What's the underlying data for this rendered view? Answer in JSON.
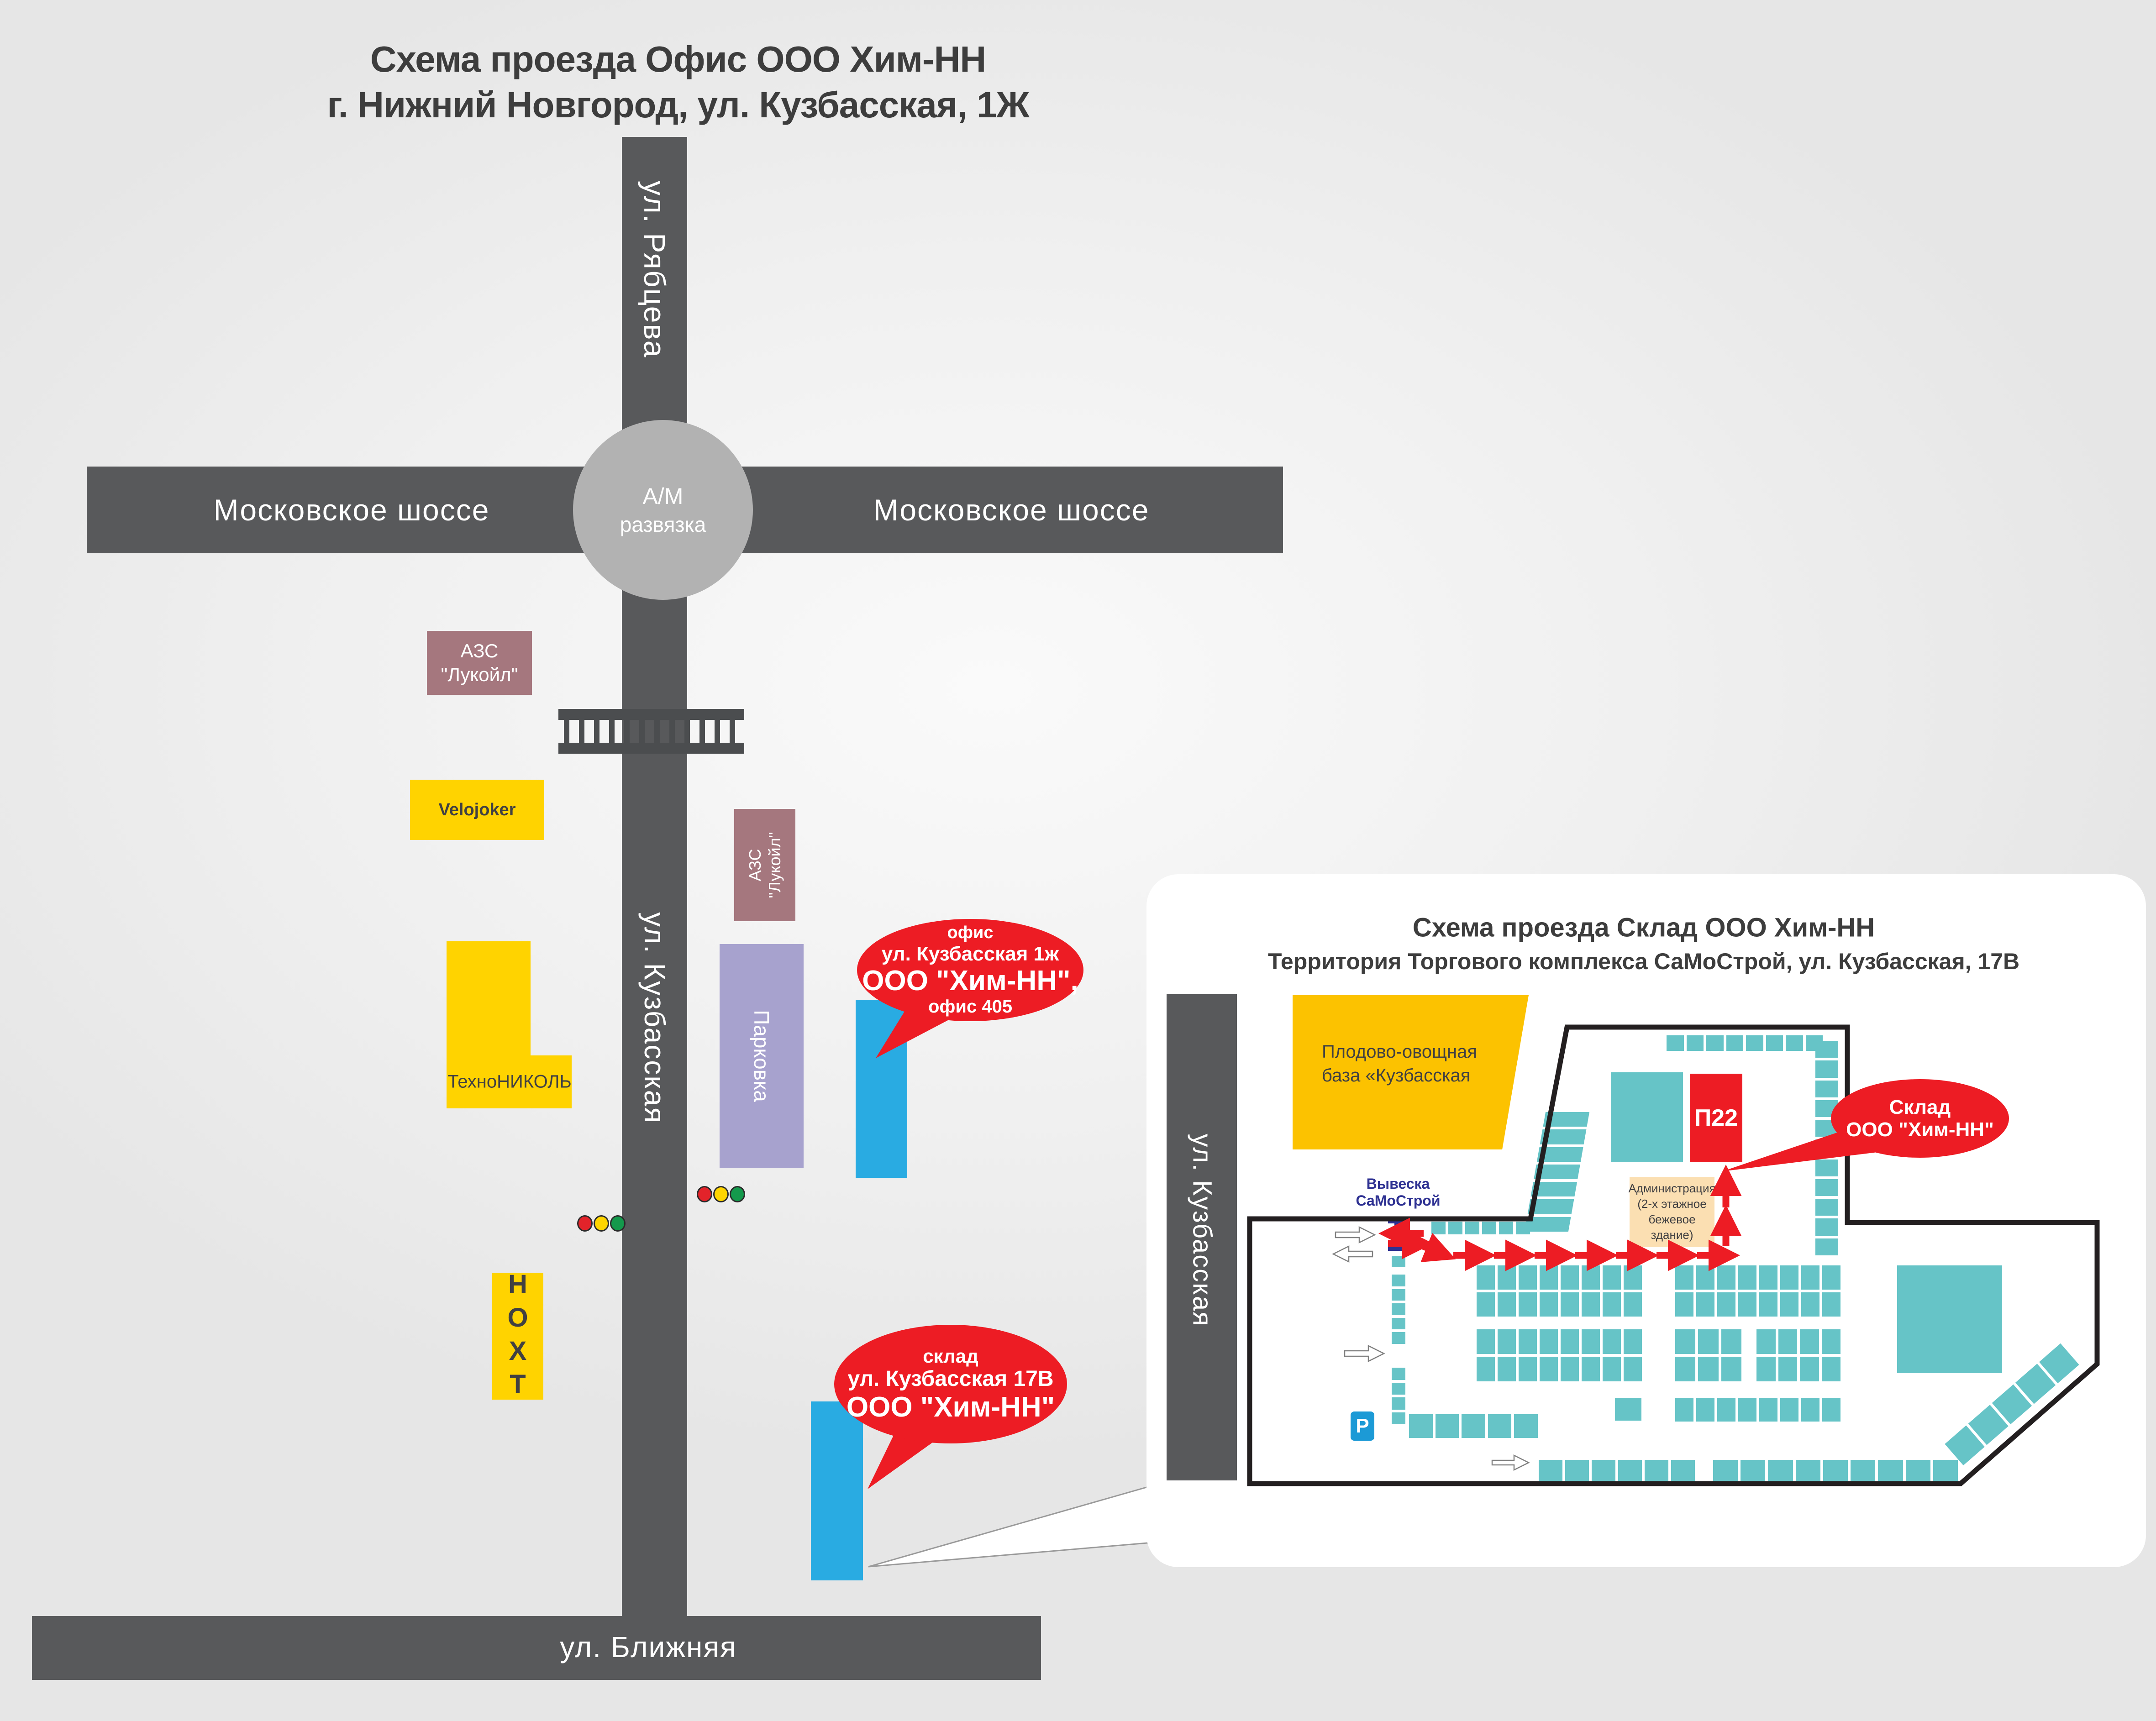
{
  "main": {
    "title": {
      "line1": "Схема проезда Офис ООО Хим-НН",
      "line2": "г. Нижний Новгород, ул. Кузбасская, 1Ж"
    },
    "roads": {
      "ryabtseva": "ул. Рябцева",
      "moscow_left": "Московское шоссе",
      "moscow_right": "Московское шоссе",
      "kuzbasskaya": "ул. Кузбасская",
      "blizhnyaya": "ул. Ближняя"
    },
    "interchange": {
      "line1": "А/М",
      "line2": "развязка"
    },
    "azs_top": {
      "line1": "АЗС",
      "line2": "\"Лукойл\""
    },
    "azs_lower": {
      "line1": "АЗС",
      "line2": "\"Лукойл\""
    },
    "velojoker": "Velojoker",
    "technonicol": "ТехноНИКОЛЬ",
    "parking": "Парковка",
    "noht": "НОХТ",
    "office_callout": {
      "line1": "офис",
      "line2": "ул. Кузбасская 1ж",
      "line3": "ООО \"Хим-НН\",",
      "line4": "офис 405"
    },
    "sklad_callout": {
      "line1": "склад",
      "line2": "ул. Кузбасская 17В",
      "line3": "ООО \"Хим-НН\""
    }
  },
  "inset": {
    "title": {
      "line1": "Схема проезда Склад ООО Хим-НН",
      "line2": "Территория Торгового комплекса СаМоСтрой, ул. Кузбасская, 17В"
    },
    "road": "ул. Кузбасская",
    "base": {
      "line1": "Плодово-овощная",
      "line2": "база «Кузбасская"
    },
    "p22": "П22",
    "sklad_bubble": {
      "line1": "Склад",
      "line2": "ООО \"Хим-НН\""
    },
    "signboard": {
      "line1": "Вывеска",
      "line2": "СаМоСтрой"
    },
    "admin": {
      "line1": "Администрация",
      "line2": "(2-х этажное",
      "line3": "бежевое",
      "line4": "здание)"
    },
    "parking_sign": "P"
  },
  "colors": {
    "road": "#58595b",
    "rail": "#4b4d4f",
    "circle_gray": "#b2b2b2",
    "accent_red": "#ed1c24",
    "building_blue": "#29abe2",
    "pavilion_teal": "#66c4c7",
    "yellow": "#ffd300",
    "base_yellow": "#fcc200",
    "mauve": "#a5777e",
    "purple": "#a7a2ce",
    "beige": "#fbdfb2",
    "navy": "#2e3192",
    "parking_blue": "#1c9ad6",
    "title_gray": "#3d3d3d",
    "boundary_black": "#231f20"
  }
}
